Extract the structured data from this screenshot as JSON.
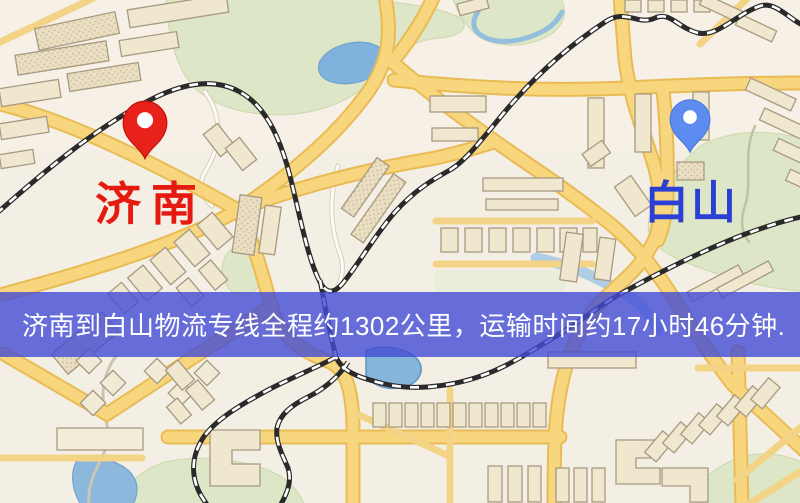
{
  "map": {
    "origin": {
      "label": "济南",
      "label_color": "#e51a10",
      "pin_color": "#e8221a",
      "pin_edge": "#c01009",
      "icon": "red-map-pin"
    },
    "destination": {
      "label": "白山",
      "label_color": "#2b3fd4",
      "pin_color": "#5d8cf0",
      "pin_edge": "#4677e0",
      "icon": "blue-map-pin"
    }
  },
  "banner": {
    "text": "济南到白山物流专线全程约1302公里，运输时间约17小时46分钟.",
    "background": "rgba(68,76,212,0.80)",
    "text_color": "#ffffff"
  },
  "route_info": {
    "origin": "济南",
    "destination": "白山",
    "distance_km": "1302",
    "duration_hours": "17",
    "duration_minutes": "46"
  },
  "palette": {
    "map_background": "#f4efe5",
    "road_yellow": "#f8d67e",
    "road_casing": "#e9bb55",
    "park_green": "#dde6c6",
    "water_blue": "#7fb2dc",
    "building_fill": "#efe7ce",
    "building_outline": "#a79a80",
    "railway_black": "#2a2a2a"
  }
}
